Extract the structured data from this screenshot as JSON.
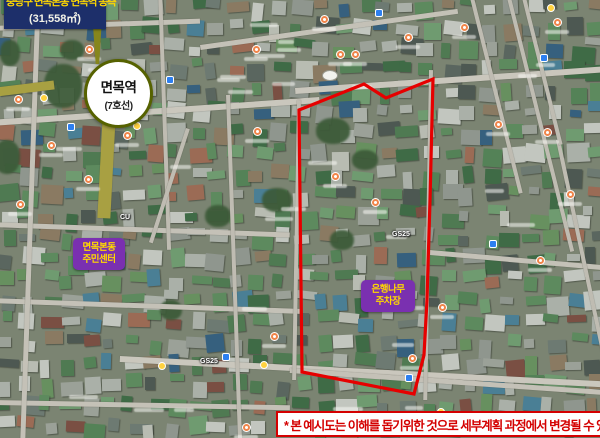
{
  "title_box": {
    "line1": "중랑구 면목본동 면목역 동측",
    "line2": "(31,558㎡)"
  },
  "station": {
    "name": "면목역",
    "line": "(7호선)"
  },
  "community_center": {
    "line1": "면목본동",
    "line2": "주민센터"
  },
  "parking": {
    "line1": "은행나무",
    "line2": "주차장"
  },
  "disclaimer": "* 본 예시도는 이해를 돕기위한 것으로 세부계획 과정에서 변경될 수 있음",
  "map": {
    "labels": [
      {
        "text": "GS25"
      },
      {
        "text": "GS25"
      },
      {
        "text": "CU"
      }
    ]
  },
  "colors": {
    "boundary_red": "#e60000",
    "title_navy": "#1d2f6a",
    "title_yellow": "#ffd800",
    "label_purple": "#7a30b0",
    "station_ring_olive": "#566200",
    "disclaimer_red": "#d40000"
  }
}
